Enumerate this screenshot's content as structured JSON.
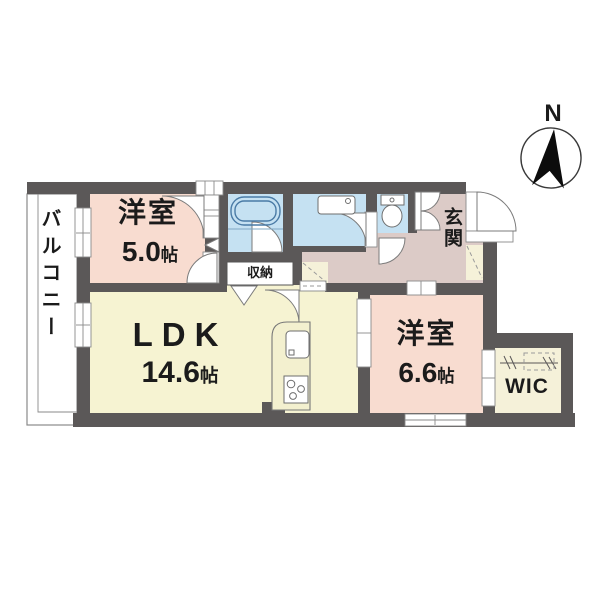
{
  "plan": {
    "compass": {
      "north_label": "N"
    },
    "rooms": {
      "bedroom_small": {
        "name": "洋室",
        "area": "5.0",
        "unit": "帖"
      },
      "ldk": {
        "name": "LDK",
        "area": "14.6",
        "unit": "帖"
      },
      "bedroom_large": {
        "name": "洋室",
        "area": "6.6",
        "unit": "帖"
      },
      "balcony": {
        "name": "バルコニー"
      },
      "entrance": {
        "name": "玄関"
      },
      "storage": {
        "name": "収納"
      },
      "walk_in_closet": {
        "name": "WIC"
      }
    },
    "colors": {
      "wall": "#5b5858",
      "bedroom": "#f8dcd0",
      "ldk": "#f6f3d2",
      "wet_area": "#c5e1f2",
      "hall_entrance": "#dccbc7",
      "closet_cream": "#f5f1d9",
      "balcony_white": "#ffffff",
      "storage_white": "#ffffff"
    }
  }
}
